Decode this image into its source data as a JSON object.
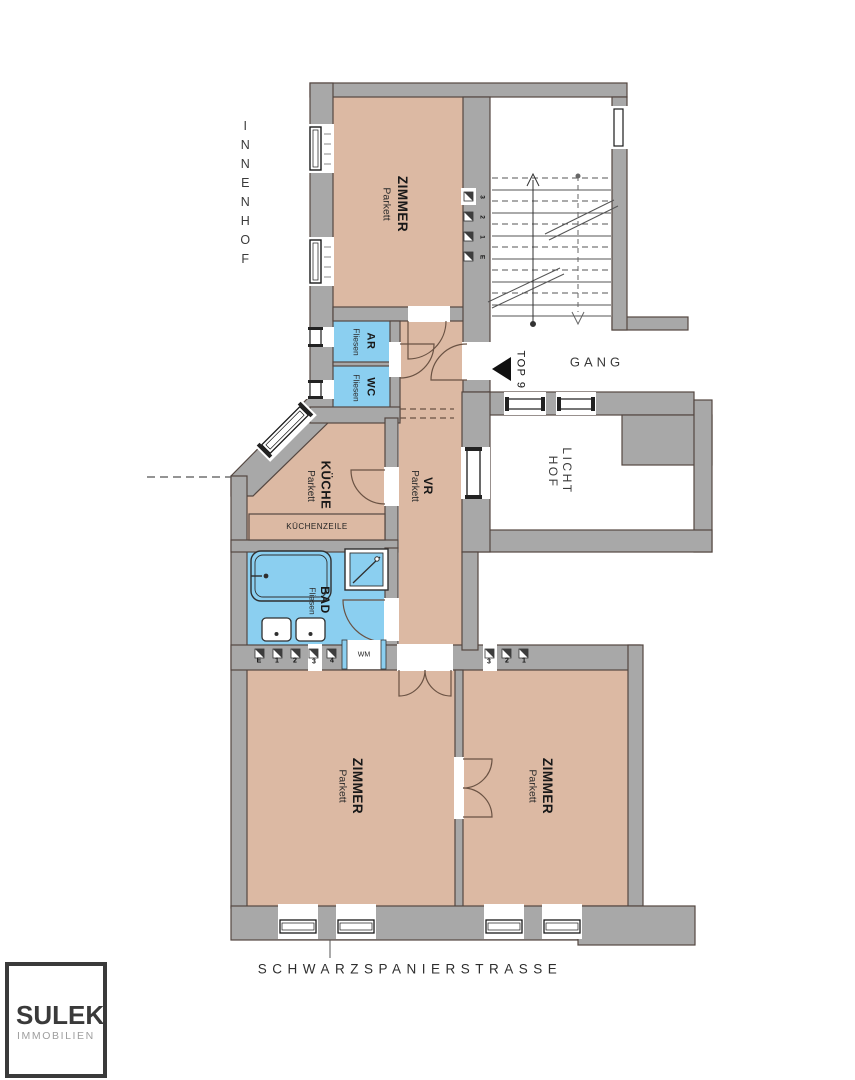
{
  "plan": {
    "street_label": "SCHWARZSPANIERSTRASSE",
    "courtyard_label": "INNENHOF",
    "corridor_label": "GANG",
    "light_well": {
      "line1": "LICHT",
      "line2": "HOF"
    },
    "unit_marker": "TOP 9",
    "rooms": {
      "zimmer_top": {
        "name": "ZIMMER",
        "floor": "Parkett"
      },
      "ar": {
        "name": "AR",
        "floor": "Fliesen"
      },
      "wc": {
        "name": "WC",
        "floor": "Fliesen"
      },
      "kueche": {
        "name": "KÜCHE",
        "floor": "Parkett"
      },
      "kuechenzeile": {
        "name": "KÜCHENZEILE"
      },
      "vr": {
        "name": "VR",
        "floor": "Parkett"
      },
      "bad": {
        "name": "BAD",
        "floor": "Fliesen"
      },
      "wm": {
        "name": "WM"
      },
      "zimmer_left": {
        "name": "ZIMMER",
        "floor": "Parkett"
      },
      "zimmer_right": {
        "name": "ZIMMER",
        "floor": "Parkett"
      }
    },
    "shaft_markers": {
      "bath_row": [
        "E",
        "1",
        "2",
        "3",
        "4"
      ],
      "room_row": [
        "3",
        "2",
        "1"
      ],
      "stair_column": [
        "3",
        "2",
        "1",
        "E"
      ]
    },
    "colors": {
      "wall": "#a8a8a8",
      "room_parkett": "#dcb9a3",
      "room_fliesen": "#8bcff0",
      "outline": "#544741"
    }
  },
  "logo": {
    "name": "SULEK",
    "subtitle": "IMMOBILIEN"
  }
}
